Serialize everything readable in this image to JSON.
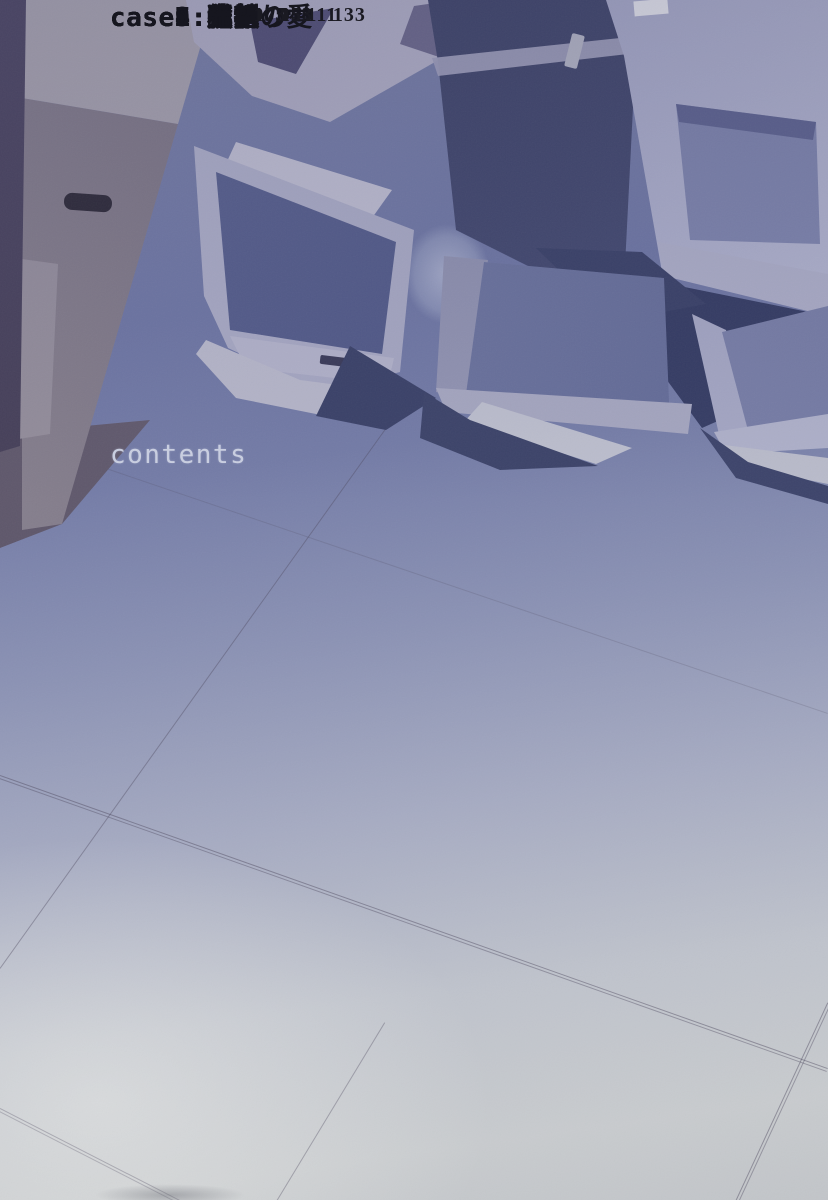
{
  "page": {
    "title": "contents",
    "toc": [
      {
        "label": "case1:噂",
        "page": "005"
      },
      {
        "label": "case2:選択",
        "page": "029"
      },
      {
        "label": "case3:少年",
        "page": "049"
      },
      {
        "label": "case4:強制",
        "page": "070"
      },
      {
        "label": "case5:父親",
        "page": "091"
      },
      {
        "label": "case6:身替り",
        "page": "111"
      },
      {
        "label": "case7:積年の愛",
        "page": "133"
      },
      {
        "label": "case8:絶望",
        "page": "153"
      },
      {
        "label": "case9:光",
        "page": "173"
      }
    ]
  },
  "background": {
    "photo_description": "blue-tinted photograph of discarded CRT monitors and cardboard boxes stacked on a pale tiled floor",
    "palette": {
      "floor_top": "#6e76a4",
      "floor_bottom": "#c6c9ce",
      "monitor_casing": "#aeb0ca",
      "monitor_screen_dark": "#4d5585",
      "monitor_screen_glow": "#ecedd6",
      "shadow_navy": "#39406b",
      "box_gray": "#7b7281",
      "title_text": "#c9cee0",
      "entry_text": "#16161f",
      "rule_color": "#1e1e2c"
    }
  }
}
